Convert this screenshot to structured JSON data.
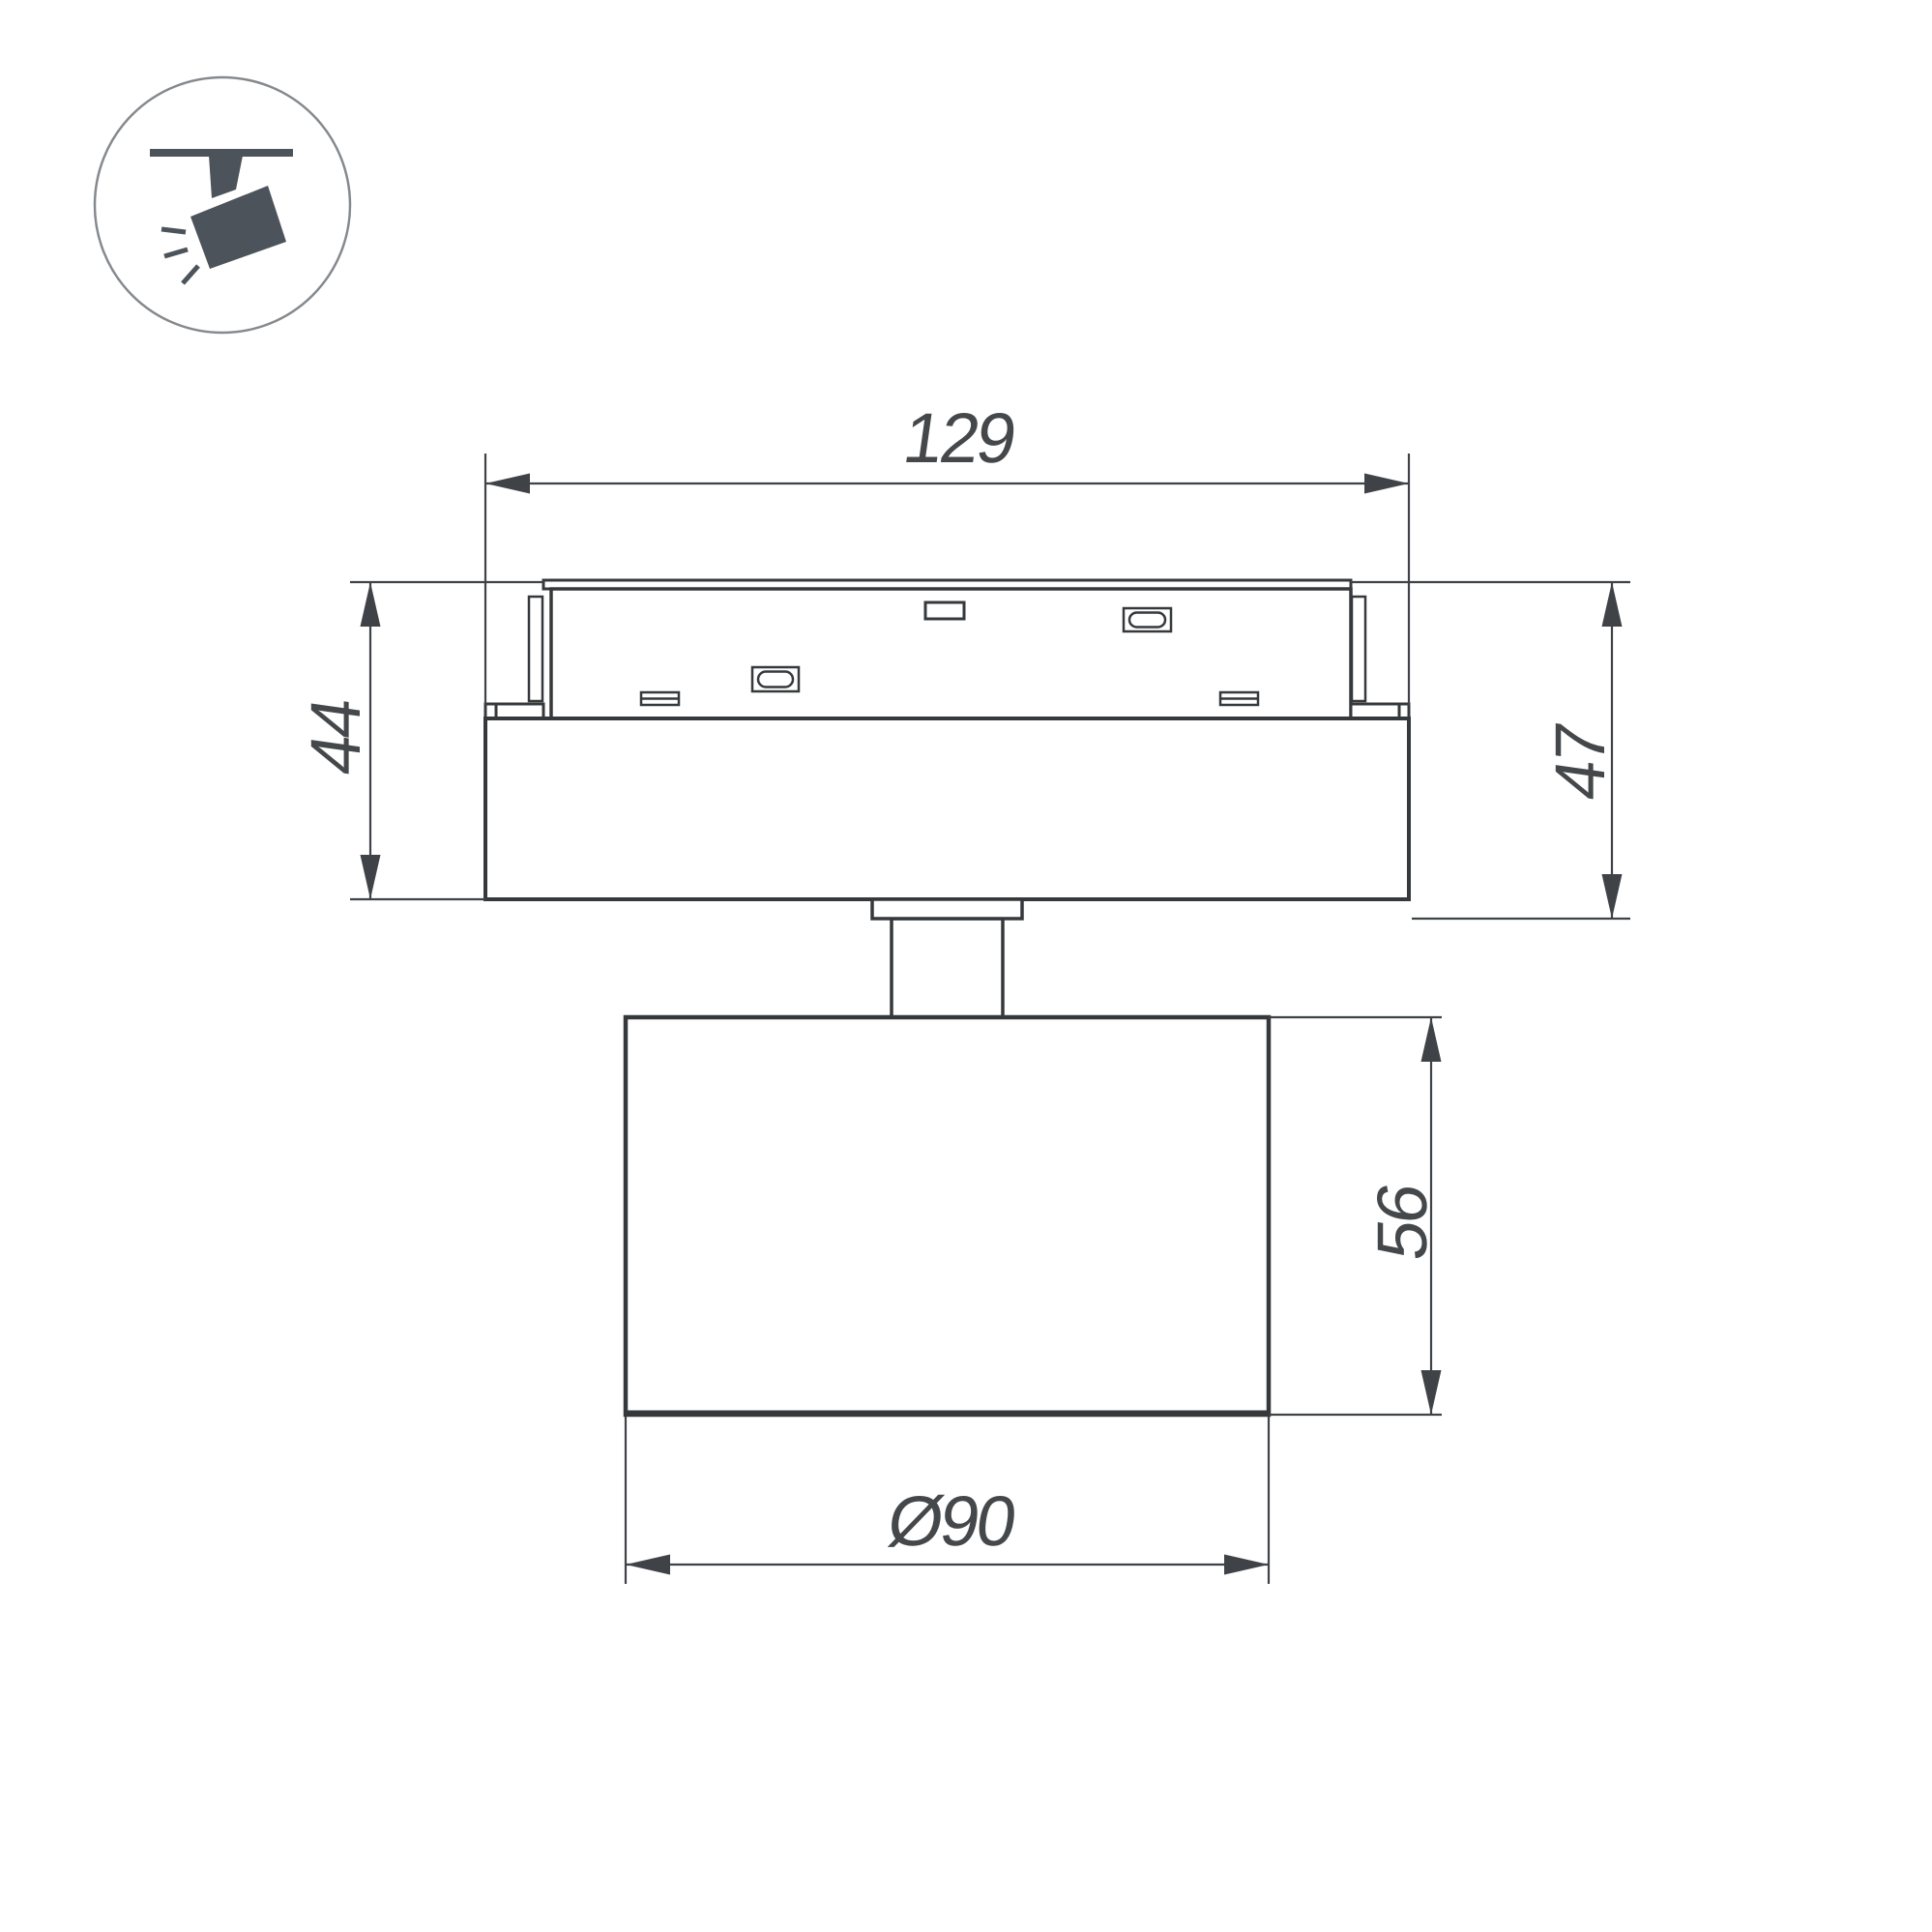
{
  "colors": {
    "background": "#ffffff",
    "line": "#36393c",
    "dimension": "#3f4347",
    "text": "#44484b",
    "icon_glyph": "#4c535a",
    "icon_circle_stroke": "#85898d"
  },
  "icon": {
    "name": "ceiling-track-spotlight"
  },
  "dimensions": {
    "track_width": {
      "label": "129"
    },
    "left_height": {
      "label": "44"
    },
    "right_height": {
      "label": "47"
    },
    "head_height": {
      "label": "56"
    },
    "head_diameter": {
      "label": "Ø90"
    }
  }
}
